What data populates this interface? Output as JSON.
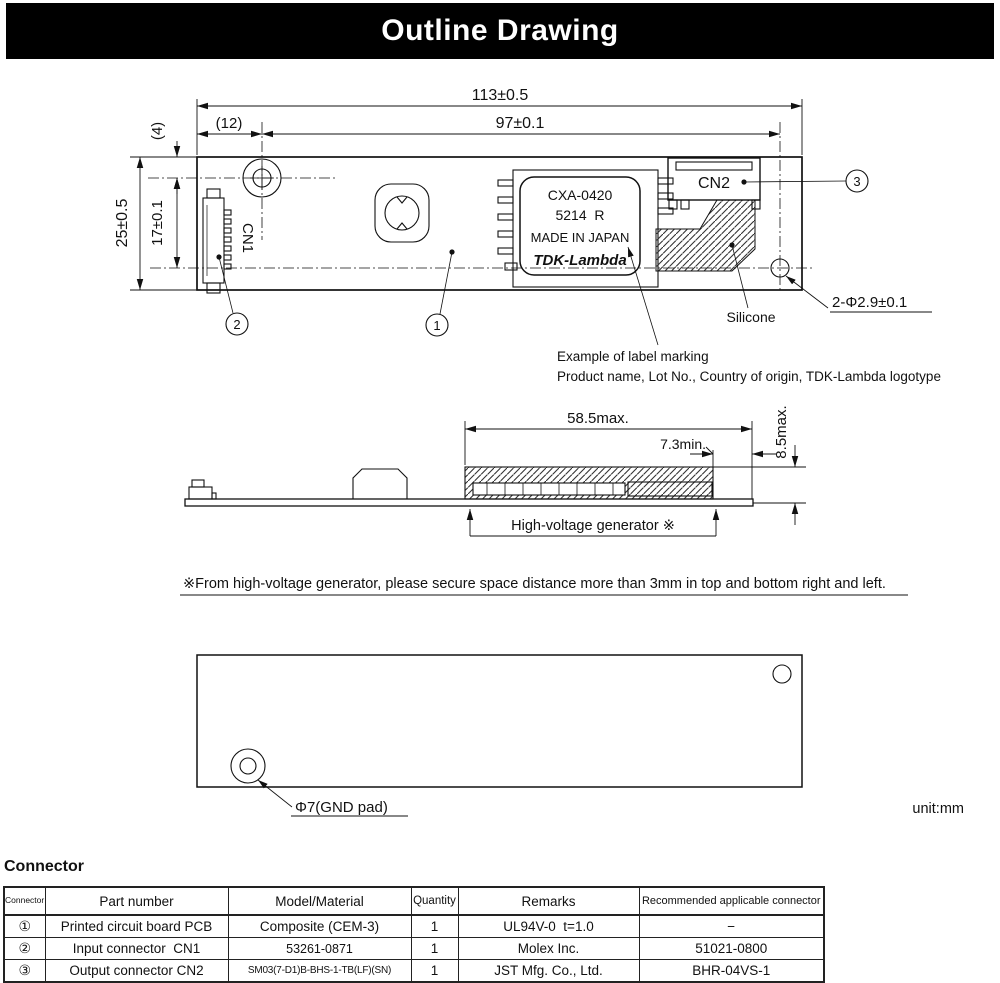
{
  "title": "Outline Drawing",
  "unit": "unit:mm",
  "top_view": {
    "dims": {
      "overall_width": "113±0.5",
      "hole_pitch": "97±0.1",
      "left_offset": "(12)",
      "top_offset": "(4)",
      "overall_height": "25±0.5",
      "centerline_pitch": "17±0.1",
      "corner_holes": "2-Φ2.9±0.1"
    },
    "labels": {
      "cn1": "CN1",
      "cn2": "CN2",
      "silicone": "Silicone"
    },
    "balloons": {
      "b1": "1",
      "b2": "2",
      "b3": "3"
    },
    "product_label": {
      "line1": "CXA-0420",
      "line2": "5214  R",
      "line3": "MADE IN JAPAN",
      "logo": "TDK-Lambda"
    },
    "label_note_line1": "Example of label marking",
    "label_note_line2": "Product name, Lot No., Country of origin, TDK-Lambda logotype"
  },
  "side_view": {
    "dims": {
      "hv_width": "58.5max.",
      "edge_clearance": "7.3min.",
      "height": "8.5max."
    },
    "hv_label": "High-voltage generator ※"
  },
  "note": "※From high-voltage generator, please secure space distance more than 3mm in top and bottom right and left.",
  "bottom_view": {
    "gnd_label": "Φ7(GND pad)"
  },
  "connector_section": {
    "heading": "Connector",
    "table": {
      "headers": [
        "Connector number",
        "Part number",
        "Model/Material",
        "Quantity",
        "Remarks",
        "Recommended applicable connector"
      ],
      "rows": [
        {
          "no": "①",
          "part": "Printed circuit board PCB",
          "model": "Composite (CEM-3)",
          "qty": "1",
          "remarks": "UL94V-0  t=1.0",
          "recommended": "−"
        },
        {
          "no": "②",
          "part": "Input connector  CN1",
          "model": "53261-0871",
          "qty": "1",
          "remarks": "Molex Inc.",
          "recommended": "51021-0800"
        },
        {
          "no": "③",
          "part": "Output connector CN2",
          "model": "SM03(7-D1)B-BHS-1-TB(LF)(SN)",
          "qty": "1",
          "remarks": "JST Mfg. Co., Ltd.",
          "recommended": "BHR-04VS-1"
        }
      ]
    }
  }
}
